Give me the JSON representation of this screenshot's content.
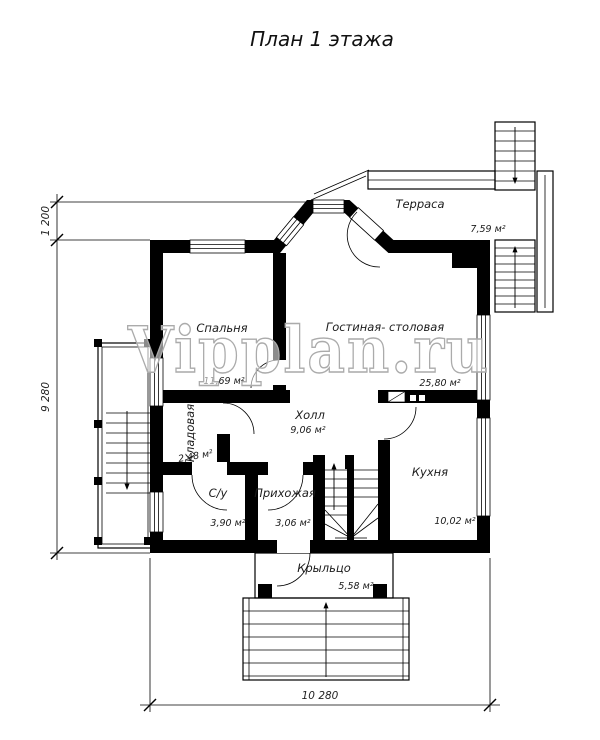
{
  "title": "План 1 этажа",
  "watermark": "Vipplan.ru",
  "rooms": {
    "bedroom": {
      "name": "Спальня",
      "area": "11,69 м²"
    },
    "living": {
      "name": "Гостиная- столовая",
      "area": "25,80 м²"
    },
    "hall": {
      "name": "Холл",
      "area": "9,06 м²"
    },
    "storeroom": {
      "name": "Кладовая",
      "area": "2,48 м²"
    },
    "wc": {
      "name": "С/у",
      "area": "3,90 м²"
    },
    "entry": {
      "name": "Прихожая",
      "area": "3,06 м²"
    },
    "kitchen": {
      "name": "Кухня",
      "area": "10,02 м²"
    },
    "terrace": {
      "name": "Терраса",
      "area": "7,59 м²"
    },
    "porch": {
      "name": "Крыльцо",
      "area": "5,58 м²"
    }
  },
  "dimensions": {
    "left_top": "1 200",
    "left_side": "9 280",
    "bottom": "10 280"
  },
  "colors": {
    "wall": "#000000",
    "line": "#1a1a1a",
    "watermark_outline": "#ababab",
    "background": "#ffffff"
  }
}
